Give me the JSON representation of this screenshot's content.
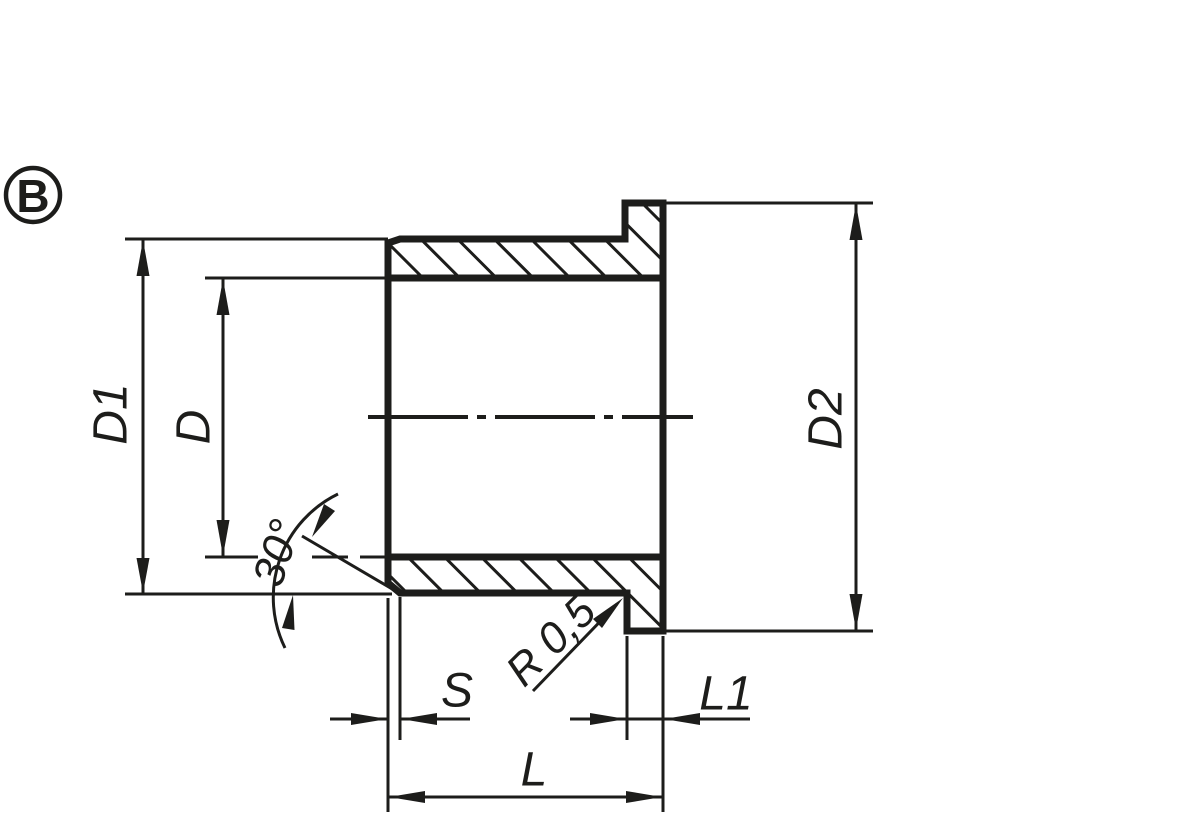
{
  "drawing": {
    "view_label": "B",
    "colors": {
      "line": "#1d1d1b",
      "background": "#ffffff"
    },
    "labels": {
      "outer_diameter": "D1",
      "bore_diameter": "D",
      "flange_diameter": "D2",
      "total_length": "L",
      "flange_thickness": "L1",
      "wall_thickness": "S",
      "chamfer_angle": "30°",
      "fillet_radius": "R 0,5"
    }
  }
}
